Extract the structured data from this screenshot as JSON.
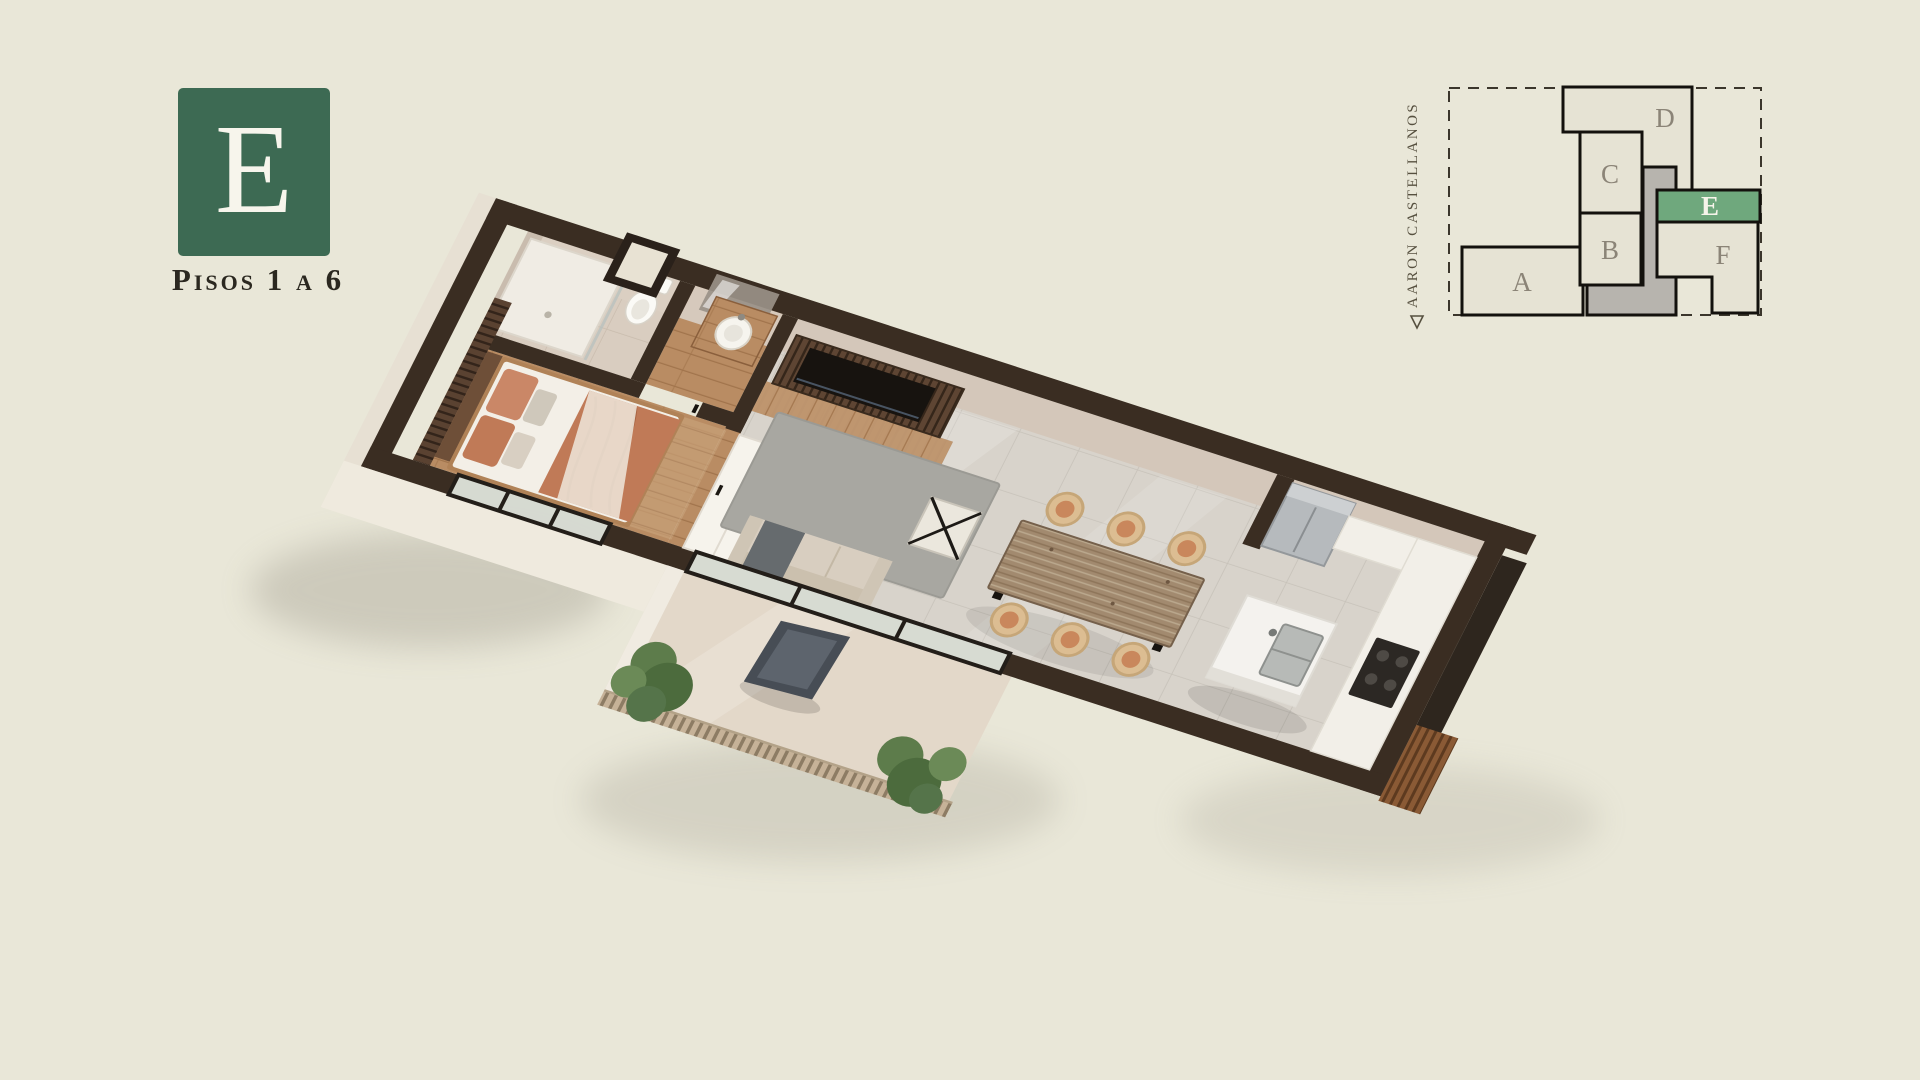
{
  "page": {
    "background_color": "#e9e7d8",
    "width": 1920,
    "height": 1080
  },
  "logo": {
    "letter": "E",
    "subtitle": "Pisos 1 a 6",
    "box_color": "#3d6a53",
    "letter_color": "#f7f5ec",
    "subtitle_color": "#2b2820"
  },
  "key_plan": {
    "street_label": "AARON CASTELLANOS",
    "street_arrow_icon": "triangle-down",
    "street_label_color": "#56503f",
    "boundary_style": "dashed",
    "outline_color": "#13110d",
    "unit_fill": "#e6e3d4",
    "core_fill": "#b7b4ae",
    "label_color": "#8b8477",
    "highlight_fill": "#6fa87d",
    "highlight_label_color": "#f6f4ea",
    "units": [
      {
        "id": "A",
        "highlighted": false
      },
      {
        "id": "B",
        "highlighted": false
      },
      {
        "id": "C",
        "highlighted": false
      },
      {
        "id": "D",
        "highlighted": false
      },
      {
        "id": "E",
        "highlighted": true
      },
      {
        "id": "F",
        "highlighted": false
      }
    ]
  },
  "floor_plan": {
    "type": "3d-axonometric-render",
    "unit": "E",
    "colors": {
      "wall": "#3a2d22",
      "wall_face": "#d4c7ba",
      "tile_floor": "#d8d3cb",
      "wood_floor": "#b98c63",
      "bath_floor": "#d9cdc0",
      "balcony_floor": "#e3d8c9",
      "exterior_face": "#efeade",
      "marble": "#f3f1ed",
      "terracotta": "#c07a57",
      "plant_green": "#55744a",
      "slat_wood": "#5e4533",
      "rug_gray": "#a8a7a1",
      "glass": "#ccd3ce"
    },
    "rooms": [
      "bathroom",
      "powder-room",
      "bedroom",
      "closet",
      "living-room",
      "dining-area",
      "kitchen",
      "balcony"
    ],
    "furniture": [
      "shower",
      "toilet",
      "window",
      "washbasin-vanity",
      "mirror",
      "double-bed",
      "slat-accent-wall",
      "wardrobe",
      "tv-slat-wall",
      "tv",
      "sofa",
      "rug",
      "coffee-table",
      "dining-table",
      "dining-chairs",
      "kitchen-island",
      "island-sink",
      "refrigerator",
      "cooktop-counter",
      "butterfly-chair",
      "planters",
      "slat-railing",
      "sliding-glass-doors"
    ]
  }
}
